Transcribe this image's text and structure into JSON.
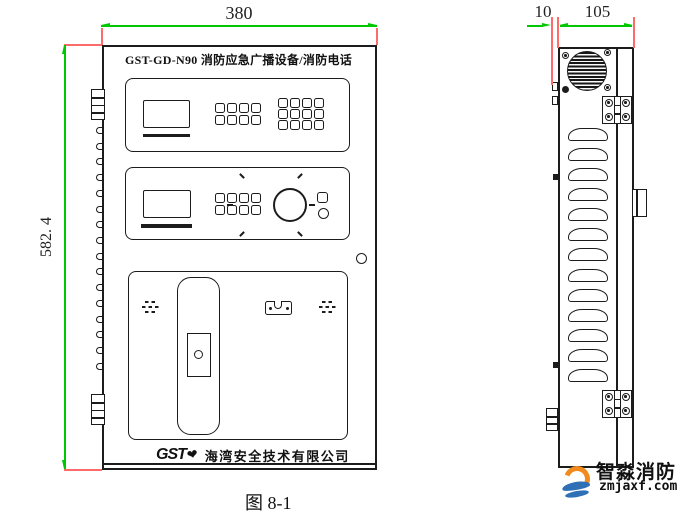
{
  "colors": {
    "line": "#1c1c1c",
    "dim": "#00c800",
    "ext": "#ff6a6a",
    "wm_orange": "#f08c1e",
    "wm_blue": "#2f6fb5"
  },
  "caption": "图 8-1",
  "dimensions": {
    "width": "380",
    "height": "582. 4",
    "door": "10",
    "depth": "105"
  },
  "front_view": {
    "title": "GST-GD-N90 消防应急广播设备/消防电话",
    "brand": "GST",
    "company": "海湾安全技术有限公司",
    "keypad_left_buttons": 8,
    "keypad_right_buttons": 12,
    "keypad_mid_buttons": 8,
    "edge_bumps": 16
  },
  "side_view": {
    "louvers": 13
  },
  "watermark": {
    "name": "智淼消防",
    "site": "zmjaxf.com"
  }
}
